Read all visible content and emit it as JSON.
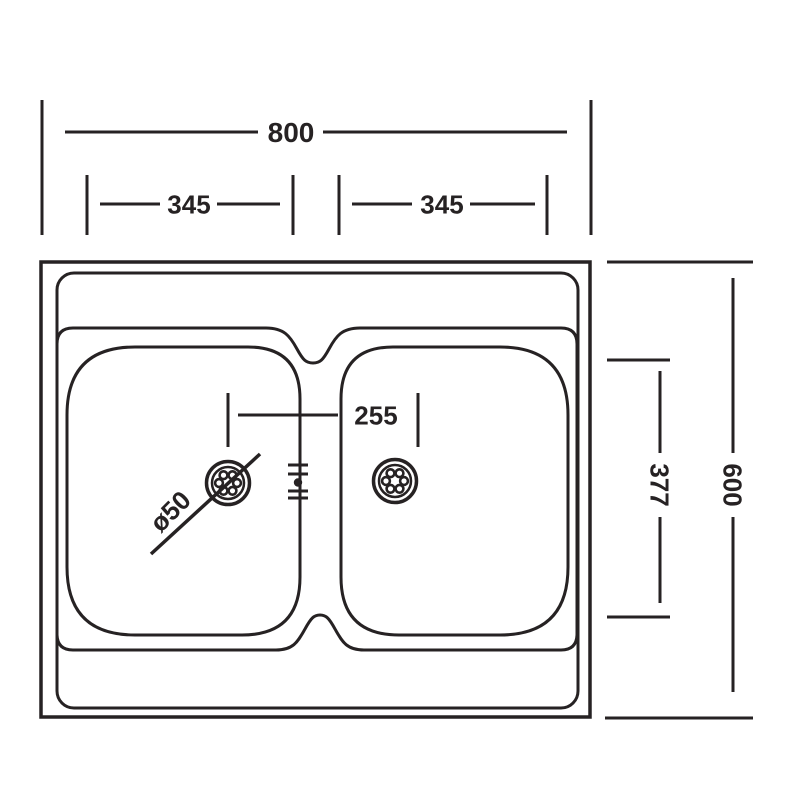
{
  "drawing": {
    "name": "Double bowl sink - dimensioned plan view",
    "line_color": "#262223",
    "background_color": "#ffffff"
  },
  "dimensions": {
    "overall_width": "800",
    "left_bowl_width": "345",
    "right_bowl_width": "345",
    "drain_spacing": "255",
    "drain_diameter": "ø50",
    "bowl_depth": "377",
    "overall_depth": "600"
  }
}
